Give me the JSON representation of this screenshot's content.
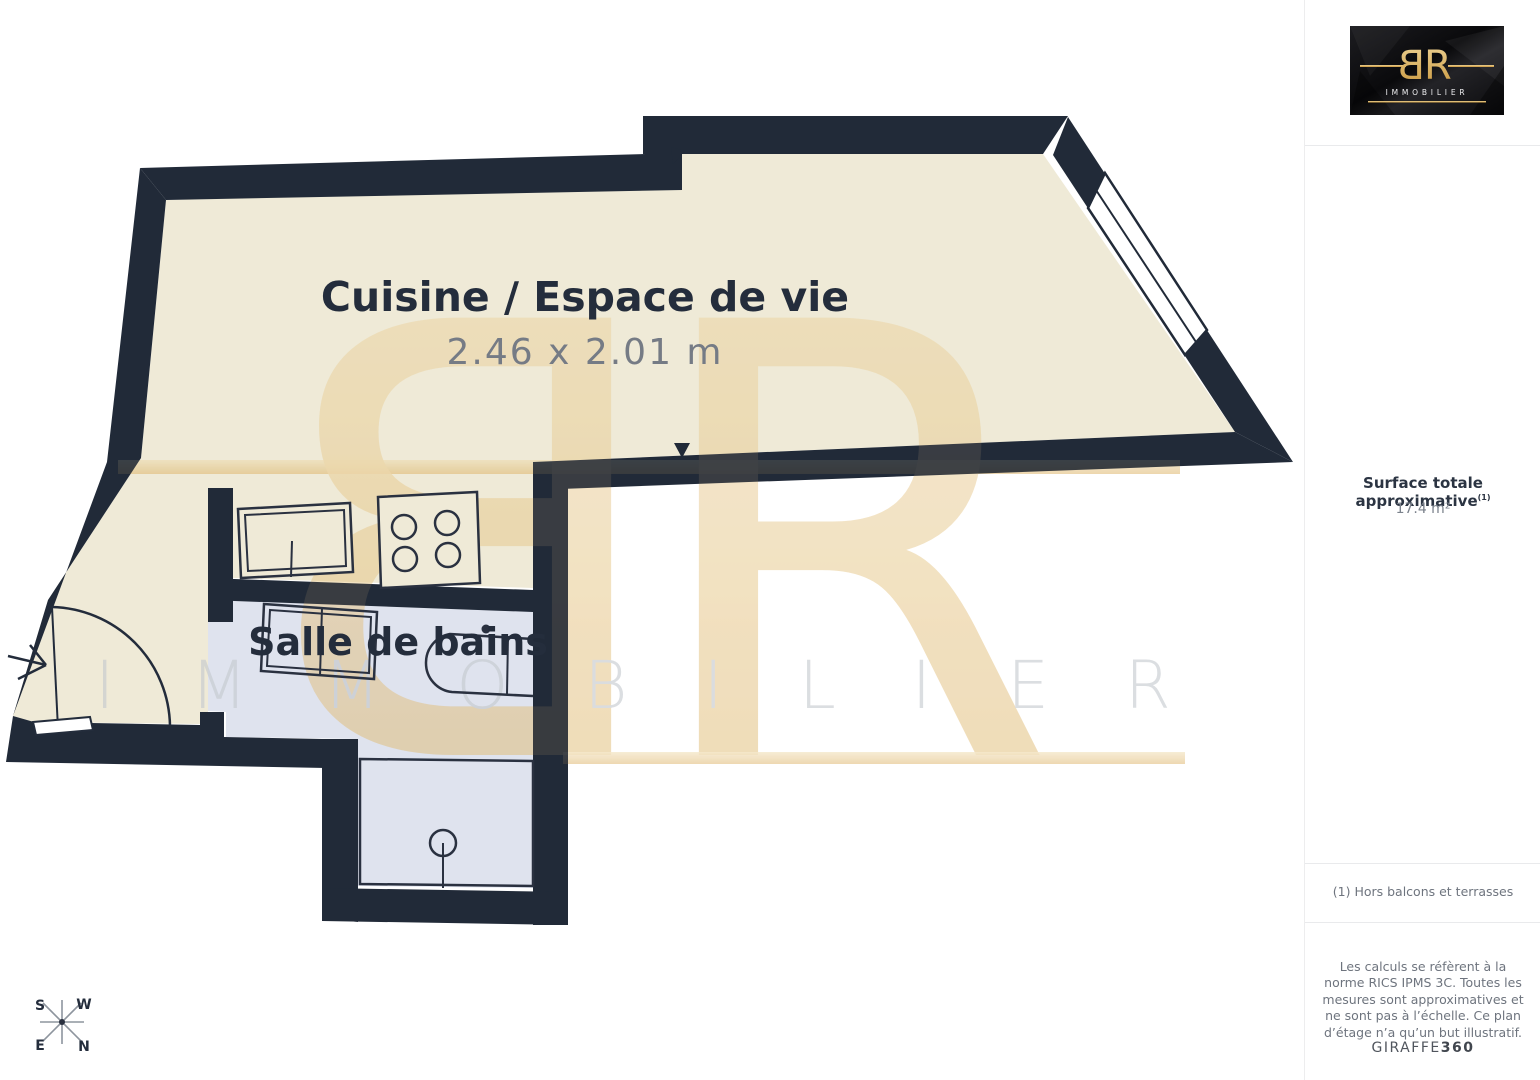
{
  "floorplan": {
    "rooms": [
      {
        "name": "Cuisine / Espace de vie",
        "dimensions": "2.46 x 2.01 m"
      },
      {
        "name": "Salle de bains"
      }
    ],
    "compass": {
      "top_left": "S",
      "top_right": "W",
      "bottom_left": "E",
      "bottom_right": "N"
    },
    "watermark": {
      "monogram_b": "B",
      "monogram_r": "R",
      "text": "IMMOBILIER"
    },
    "colors": {
      "wall": "#212a38",
      "floor_main": "#efead7",
      "floor_bath": "#dfe3ee",
      "watermark_gold": "#e3c07a",
      "watermark_gray": "#c3c8ce"
    }
  },
  "sidebar": {
    "logo": {
      "monogram_b": "B",
      "monogram_r": "R",
      "brand": "IMMOBILIER"
    },
    "surface": {
      "label": "Surface totale approximative",
      "footnote_ref": "(1)",
      "value": "17.4 m²"
    },
    "footnote": "(1) Hors balcons et terrasses",
    "legal": "Les calculs se réfèrent à la norme RICS IPMS 3C. Toutes les mesures sont approximatives et ne sont pas à l’échelle. Ce plan d’étage n’a qu’un but illustratif.",
    "brand_footer": {
      "name": "GIRAFFE",
      "suffix": "360"
    }
  }
}
